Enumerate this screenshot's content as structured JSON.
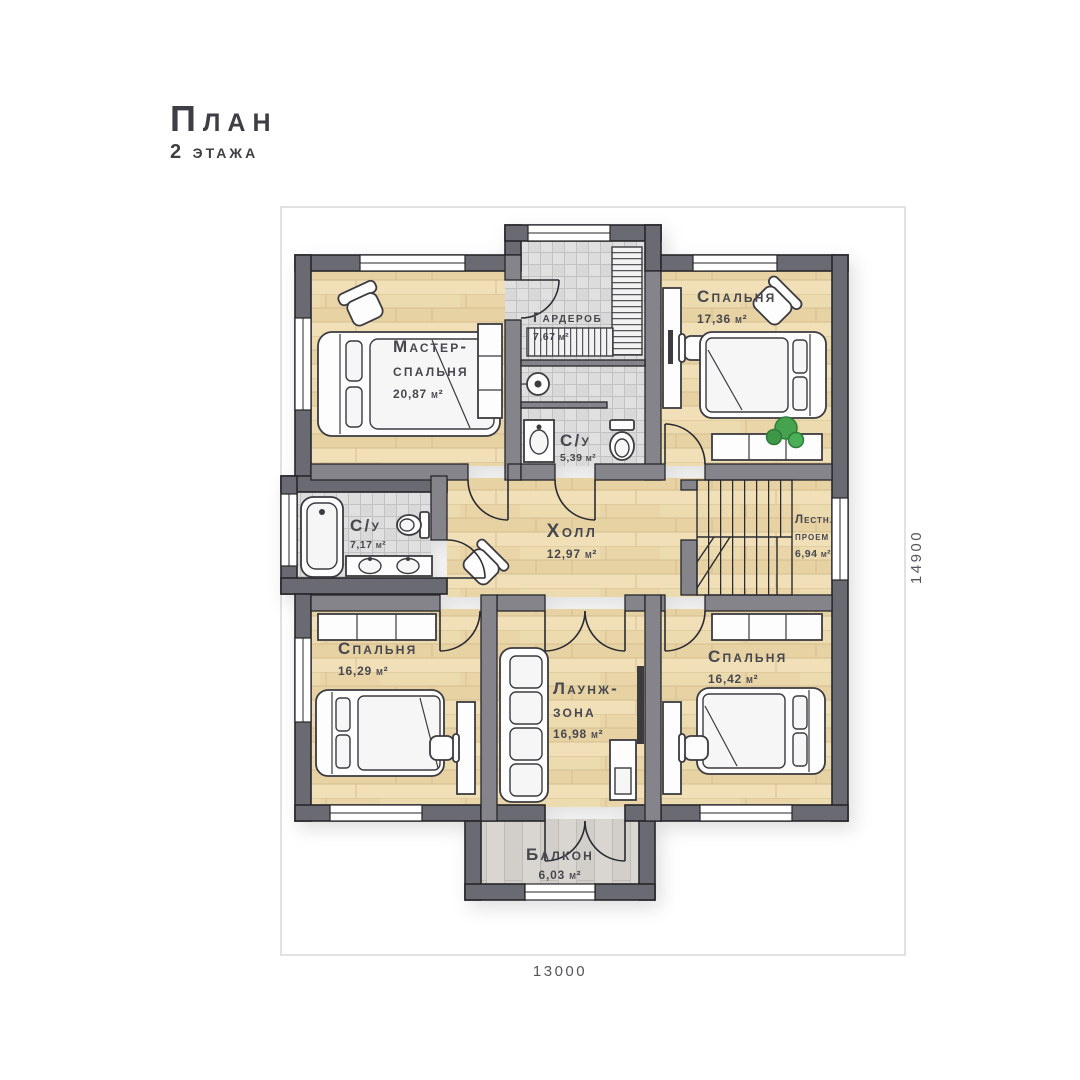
{
  "title": {
    "line1": "План",
    "line2": "2 этажа"
  },
  "dimensions": {
    "bottom": "13000",
    "right": "14900"
  },
  "rooms": {
    "master": {
      "name1": "Мастер-",
      "name2": "спальня",
      "area": "20,87 м²"
    },
    "wardrobe": {
      "name": "Гардероб",
      "area": "7,67 м²"
    },
    "bedroom_top_right": {
      "name": "Спальня",
      "area": "17,36 м²"
    },
    "bath_small": {
      "name": "С/у",
      "area": "5,39 м²"
    },
    "bath_large": {
      "name": "С/у",
      "area": "7,17 м²"
    },
    "hall": {
      "name": "Холл",
      "area": "12,97 м²"
    },
    "stairwell": {
      "name1": "Лестн.",
      "name2": "проем",
      "area": "6,94 м²"
    },
    "bedroom_bottom_left": {
      "name": "Спальня",
      "area": "16,29 м²"
    },
    "lounge": {
      "name1": "Лаунж-",
      "name2": "зона",
      "area": "16,98 м²"
    },
    "bedroom_bottom_right": {
      "name": "Спальня",
      "area": "16,42 м²"
    },
    "balcony": {
      "name": "Балкон",
      "area": "6,03 м²"
    }
  },
  "colors": {
    "wall_exterior": "#6b6b72",
    "wall_interior": "#84848a",
    "wall_outline": "#26262b",
    "wood_floor": "#eddbb0",
    "tile_floor": "#e0e0e0",
    "balcony_floor": "#d9d6d2",
    "plant_green": "#44a24f",
    "label_text": "#47474e",
    "dimension_line": "#d8d8d8"
  }
}
